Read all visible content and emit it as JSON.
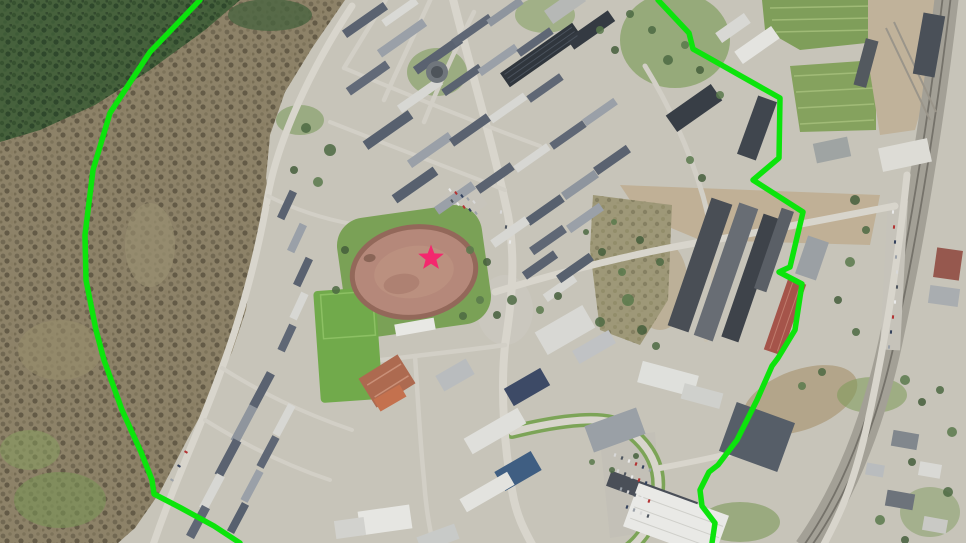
{
  "map": {
    "kind": "aerial-photo-with-zone-overlay",
    "overlay": {
      "boundary_color": "#0ce40c",
      "boundary_width": 5.5,
      "boundary_left_points": "200,0 150,52 110,113 93,170 85,235 86,280 96,330 104,360 122,410 141,452 152,480 154,494 181,508 214,526 240,543",
      "boundary_right_points": "658,0 689,33 693,49 702,54 780,98 779,158 753,180 803,212 790,267 779,272 802,284 795,330 778,358 772,366 757,400 737,440 718,465 709,472 700,490 702,506 715,523 712,543",
      "marker": {
        "shape": "star",
        "cx": 431,
        "cy": 258,
        "outer_radius": 13.5,
        "inner_ratio": 0.42,
        "color": "#f4286e"
      }
    },
    "base": {
      "tree_palette": [
        "#4d6a43",
        "#5a7a4c",
        "#455f3c"
      ],
      "car_palette": [
        "#e9e9e9",
        "#b23131",
        "#32405c",
        "#9aa0a8",
        "#d8d8d8",
        "#4d545e"
      ],
      "buildings": [
        [
          365,
          20,
          50,
          9,
          -35,
          "#5a6270"
        ],
        [
          400,
          12,
          40,
          8,
          -35,
          "#d9d9d5"
        ],
        [
          402,
          38,
          55,
          9,
          -35,
          "#9aa0a8"
        ],
        [
          438,
          55,
          55,
          9,
          -35,
          "#5a6270"
        ],
        [
          472,
          30,
          45,
          8,
          -35,
          "#5f6775"
        ],
        [
          505,
          12,
          40,
          8,
          -35,
          "#8e959e"
        ],
        [
          368,
          78,
          48,
          9,
          -35,
          "#626a78"
        ],
        [
          420,
          95,
          50,
          9,
          -35,
          "#d7d7d3"
        ],
        [
          462,
          80,
          45,
          8,
          -35,
          "#5a6270"
        ],
        [
          498,
          60,
          45,
          8,
          -35,
          "#9aa0a8"
        ],
        [
          535,
          42,
          40,
          8,
          -35,
          "#5f6775"
        ],
        [
          388,
          130,
          55,
          10,
          -35,
          "#57606e"
        ],
        [
          430,
          150,
          50,
          9,
          -35,
          "#9aa0a8"
        ],
        [
          470,
          130,
          45,
          9,
          -35,
          "#5a6270"
        ],
        [
          508,
          108,
          42,
          8,
          -35,
          "#d7d7d3"
        ],
        [
          545,
          88,
          40,
          8,
          -35,
          "#5f6775"
        ],
        [
          600,
          112,
          38,
          8,
          -35,
          "#9aa0a8"
        ],
        [
          415,
          185,
          50,
          10,
          -35,
          "#57606e"
        ],
        [
          455,
          198,
          45,
          9,
          -35,
          "#9aa0a8"
        ],
        [
          495,
          178,
          42,
          9,
          -35,
          "#5a6270"
        ],
        [
          532,
          158,
          40,
          8,
          -35,
          "#d7d7d3"
        ],
        [
          568,
          135,
          40,
          8,
          -35,
          "#5f6775"
        ],
        [
          612,
          160,
          40,
          9,
          -35,
          "#5a6270"
        ],
        [
          580,
          185,
          40,
          9,
          -35,
          "#8e959e"
        ],
        [
          545,
          210,
          42,
          9,
          -35,
          "#57606e"
        ],
        [
          510,
          232,
          42,
          9,
          -35,
          "#d7d7d3"
        ],
        [
          548,
          240,
          40,
          9,
          -35,
          "#5f6775"
        ],
        [
          585,
          218,
          40,
          9,
          -35,
          "#9aa0a8"
        ],
        [
          540,
          265,
          38,
          9,
          -35,
          "#5a6270"
        ],
        [
          560,
          288,
          36,
          9,
          -35,
          "#d7d7d3"
        ],
        [
          575,
          268,
          40,
          9,
          -35,
          "#57606e"
        ],
        [
          541,
          55,
          88,
          17,
          -35,
          "#30363d"
        ],
        [
          591,
          30,
          50,
          13,
          -35,
          "#343a42"
        ],
        [
          565,
          6,
          40,
          16,
          -35,
          "#b6b8b6"
        ],
        [
          733,
          28,
          35,
          12,
          -35,
          "#d8d8d4"
        ],
        [
          757,
          45,
          45,
          15,
          -35,
          "#e4e4e0"
        ],
        [
          694,
          108,
          55,
          20,
          -35,
          "#383e46"
        ],
        [
          757,
          128,
          20,
          62,
          20,
          "#40464e"
        ],
        [
          929,
          45,
          22,
          62,
          10,
          "#4a5058"
        ],
        [
          866,
          63,
          13,
          48,
          15,
          "#53595f"
        ],
        [
          905,
          155,
          50,
          24,
          -12,
          "#dddcd6"
        ],
        [
          832,
          150,
          35,
          20,
          -12,
          "#9fa4a3"
        ],
        [
          700,
          265,
          22,
          135,
          19,
          "#494e55"
        ],
        [
          726,
          272,
          20,
          140,
          19,
          "#686d74"
        ],
        [
          751,
          278,
          18,
          130,
          19,
          "#3e434a"
        ],
        [
          774,
          250,
          13,
          85,
          19,
          "#5a5f66"
        ],
        [
          785,
          317,
          19,
          75,
          19,
          "#a5544a"
        ],
        [
          812,
          258,
          22,
          40,
          19,
          "#9ba0a4"
        ],
        [
          948,
          264,
          26,
          30,
          8,
          "#96584e"
        ],
        [
          944,
          296,
          30,
          18,
          8,
          "#a9adb0"
        ],
        [
          565,
          330,
          55,
          26,
          -30,
          "#d8d8d4"
        ],
        [
          594,
          347,
          42,
          15,
          -30,
          "#c0c2c4"
        ],
        [
          527,
          387,
          42,
          20,
          -30,
          "#3d4a66"
        ],
        [
          495,
          431,
          62,
          18,
          -30,
          "#dfdfdb"
        ],
        [
          518,
          471,
          42,
          22,
          -30,
          "#3f5e82"
        ],
        [
          487,
          492,
          55,
          15,
          -30,
          "#e3e3df"
        ],
        [
          615,
          430,
          55,
          28,
          -20,
          "#9aa0a6"
        ],
        [
          455,
          375,
          35,
          18,
          -30,
          "#b9bcbe"
        ],
        [
          385,
          520,
          52,
          24,
          -8,
          "#e6e6e2"
        ],
        [
          350,
          528,
          30,
          18,
          -8,
          "#d2d2ce"
        ],
        [
          438,
          538,
          40,
          16,
          -20,
          "#c8cac8"
        ],
        [
          415,
          327,
          40,
          12,
          -10,
          "#e8e8e4"
        ],
        [
          652,
          494,
          92,
          16,
          20,
          "#4a4f58"
        ],
        [
          676,
          521,
          96,
          46,
          20,
          "#e9e9e6"
        ],
        [
          757,
          437,
          62,
          52,
          20,
          "#565e68"
        ],
        [
          668,
          379,
          58,
          22,
          15,
          "#dfe0dc"
        ],
        [
          702,
          396,
          40,
          16,
          15,
          "#cfd0cc"
        ],
        [
          905,
          440,
          26,
          16,
          10,
          "#81878d"
        ],
        [
          930,
          470,
          22,
          14,
          10,
          "#d9d9d5"
        ],
        [
          900,
          500,
          28,
          16,
          10,
          "#6d737b"
        ],
        [
          935,
          525,
          24,
          14,
          10,
          "#c9c9c5"
        ],
        [
          875,
          470,
          18,
          12,
          10,
          "#b9bcbe"
        ],
        [
          262,
          390,
          38,
          9,
          -62,
          "#5a6270"
        ],
        [
          244,
          424,
          40,
          9,
          -62,
          "#8f959d"
        ],
        [
          228,
          458,
          40,
          9,
          -62,
          "#5a6270"
        ],
        [
          212,
          492,
          38,
          9,
          -62,
          "#d7d7d3"
        ],
        [
          198,
          522,
          34,
          9,
          -62,
          "#5f6775"
        ],
        [
          284,
          420,
          34,
          8,
          -62,
          "#d7d7d3"
        ],
        [
          268,
          452,
          34,
          8,
          -62,
          "#5f6775"
        ],
        [
          252,
          486,
          34,
          8,
          -62,
          "#9aa0a8"
        ],
        [
          238,
          518,
          32,
          8,
          -62,
          "#57606e"
        ],
        [
          390,
          398,
          30,
          14,
          -30,
          "#c4714e"
        ],
        [
          287,
          205,
          30,
          8,
          -65,
          "#5a6270"
        ],
        [
          297,
          238,
          30,
          8,
          -65,
          "#9aa0a8"
        ],
        [
          303,
          272,
          30,
          8,
          -65,
          "#5a6270"
        ],
        [
          299,
          306,
          28,
          8,
          -65,
          "#d7d7d3"
        ],
        [
          287,
          338,
          28,
          8,
          -65,
          "#5f6775"
        ]
      ],
      "trees": [
        [
          330,
          150,
          6
        ],
        [
          318,
          182,
          5
        ],
        [
          294,
          170,
          4
        ],
        [
          306,
          128,
          5
        ],
        [
          470,
          250,
          4
        ],
        [
          487,
          262,
          4
        ],
        [
          512,
          300,
          5
        ],
        [
          540,
          310,
          4
        ],
        [
          558,
          296,
          4
        ],
        [
          600,
          322,
          5
        ],
        [
          628,
          300,
          6
        ],
        [
          642,
          330,
          5
        ],
        [
          656,
          346,
          4
        ],
        [
          690,
          160,
          4
        ],
        [
          702,
          178,
          4
        ],
        [
          668,
          60,
          5
        ],
        [
          685,
          45,
          4
        ],
        [
          700,
          70,
          4
        ],
        [
          652,
          30,
          4
        ],
        [
          720,
          95,
          4
        ],
        [
          855,
          200,
          5
        ],
        [
          866,
          230,
          4
        ],
        [
          850,
          262,
          5
        ],
        [
          838,
          300,
          4
        ],
        [
          856,
          332,
          4
        ],
        [
          905,
          380,
          5
        ],
        [
          922,
          402,
          4
        ],
        [
          940,
          390,
          4
        ],
        [
          952,
          432,
          5
        ],
        [
          912,
          462,
          4
        ],
        [
          948,
          492,
          5
        ],
        [
          880,
          520,
          5
        ],
        [
          905,
          540,
          4
        ],
        [
          612,
          470,
          3
        ],
        [
          592,
          462,
          3
        ],
        [
          636,
          456,
          3
        ],
        [
          822,
          372,
          4
        ],
        [
          802,
          386,
          4
        ],
        [
          640,
          240,
          4
        ],
        [
          660,
          262,
          4
        ],
        [
          622,
          272,
          4
        ],
        [
          602,
          252,
          4
        ],
        [
          586,
          232,
          3
        ],
        [
          614,
          222,
          3
        ],
        [
          345,
          250,
          4
        ],
        [
          336,
          290,
          4
        ],
        [
          600,
          30,
          4
        ],
        [
          615,
          50,
          4
        ],
        [
          630,
          14,
          4
        ],
        [
          480,
          300,
          4
        ],
        [
          497,
          315,
          4
        ],
        [
          463,
          316,
          4
        ]
      ],
      "cars": [
        [
          450,
          190,
          55
        ],
        [
          456,
          193,
          55
        ],
        [
          462,
          196,
          55
        ],
        [
          468,
          199,
          55
        ],
        [
          474,
          202,
          55
        ],
        [
          452,
          201,
          55
        ],
        [
          458,
          204,
          55
        ],
        [
          464,
          207,
          55
        ],
        [
          470,
          210,
          55
        ],
        [
          476,
          213,
          55
        ],
        [
          615,
          455,
          110
        ],
        [
          622,
          458,
          110
        ],
        [
          629,
          461,
          110
        ],
        [
          636,
          464,
          110
        ],
        [
          643,
          467,
          110
        ],
        [
          650,
          470,
          110
        ],
        [
          618,
          471,
          110
        ],
        [
          625,
          474,
          110
        ],
        [
          632,
          477,
          110
        ],
        [
          639,
          480,
          110
        ],
        [
          646,
          483,
          110
        ],
        [
          621,
          489,
          110
        ],
        [
          628,
          492,
          110
        ],
        [
          635,
          495,
          110
        ],
        [
          642,
          498,
          110
        ],
        [
          649,
          501,
          110
        ],
        [
          627,
          507,
          110
        ],
        [
          634,
          510,
          110
        ],
        [
          641,
          513,
          110
        ],
        [
          648,
          516,
          110
        ],
        [
          893,
          212,
          95
        ],
        [
          894,
          227,
          95
        ],
        [
          895,
          242,
          95
        ],
        [
          896,
          257,
          95
        ],
        [
          897,
          272,
          95
        ],
        [
          897,
          287,
          95
        ],
        [
          895,
          302,
          95
        ],
        [
          893,
          317,
          95
        ],
        [
          891,
          332,
          95
        ],
        [
          889,
          347,
          95
        ],
        [
          501,
          212,
          -80
        ],
        [
          506,
          227,
          -80
        ],
        [
          510,
          242,
          -80
        ],
        [
          186,
          452,
          30
        ],
        [
          179,
          466,
          30
        ],
        [
          172,
          480,
          30
        ]
      ]
    }
  }
}
